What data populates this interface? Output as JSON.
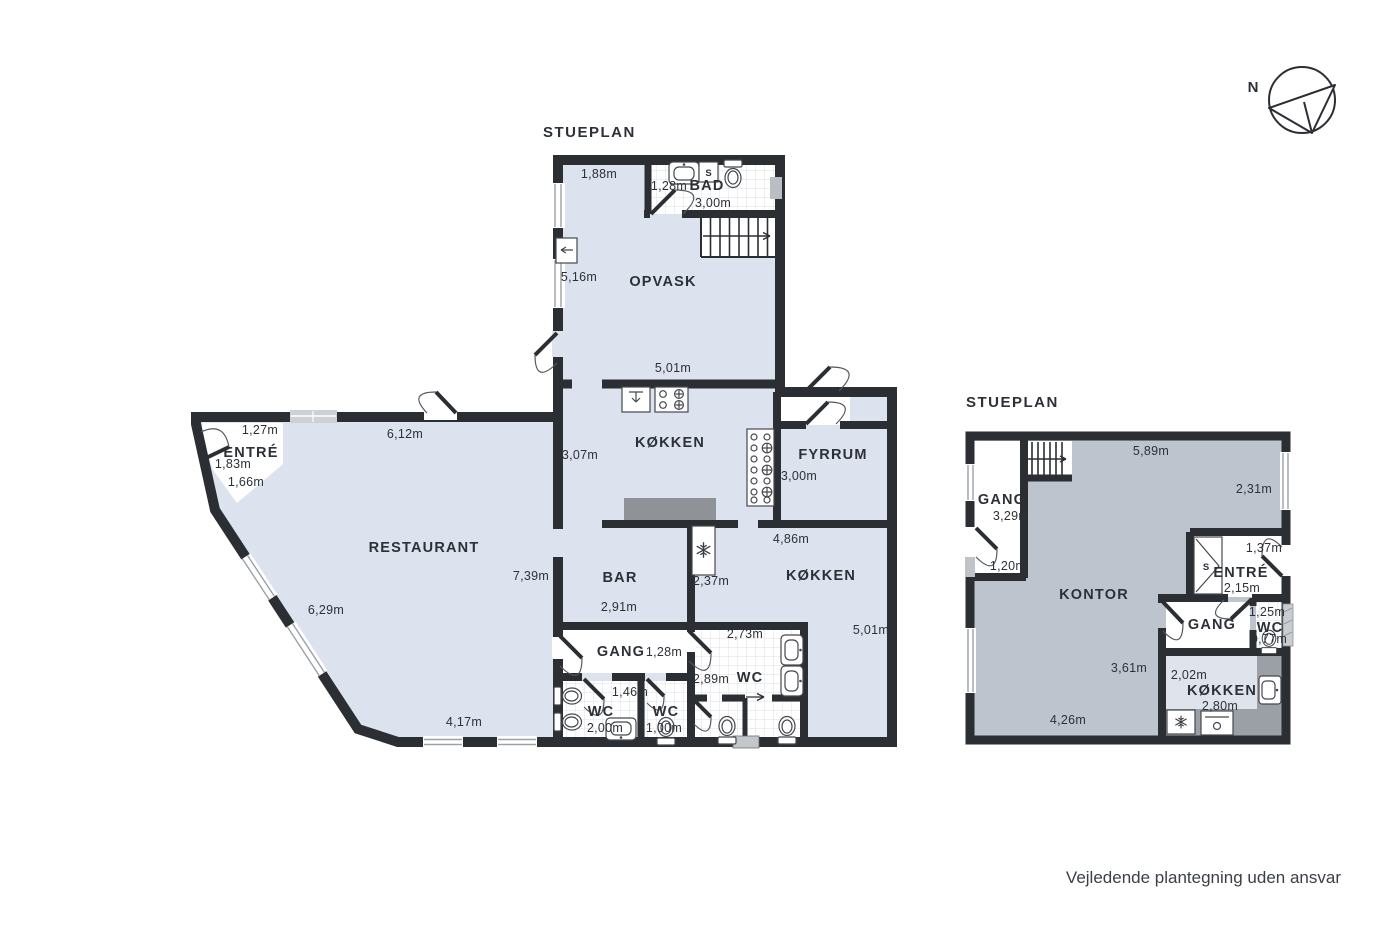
{
  "page": {
    "footer": "Vejledende plantegning uden ansvar",
    "compass_label": "N"
  },
  "colors": {
    "wall": "#2b2e33",
    "floor_light": "#dce2ee",
    "floor_gray": "#bec4cd",
    "floor_kitchen_upper": "#dfe3eb",
    "counter": "#8f9297",
    "counter_upper": "#9aa0a6",
    "tile_line": "#dcdfe3"
  },
  "plan_main": {
    "title": "STUEPLAN",
    "labels": {
      "bad": "BAD",
      "opvask": "OPVASK",
      "kokken_top": "KØKKEN",
      "fyrrum": "FYRRUM",
      "restaurant": "RESTAURANT",
      "entre": "ENTRÉ",
      "bar": "BAR",
      "kokken_right": "KØKKEN",
      "gang": "GANG",
      "wc_left": "WC",
      "wc_mid": "WC",
      "wc_right": "WC",
      "closet": "S"
    },
    "dims": {
      "top_width": "1,88m",
      "bad_door": "1,28m",
      "bad_width": "3,00m",
      "opvask_height": "5,16m",
      "kokken_top_width": "5,01m",
      "kokken_height": "3,07m",
      "fyrrum_height": "3,00m",
      "entre_top": "1,27m",
      "entre_door": "1,83m",
      "entre_inner": "1,66m",
      "rest_top": "6,12m",
      "rest_right": "7,39m",
      "rest_diag": "6,29m",
      "rest_bottom": "4,17m",
      "bar_width": "2,91m",
      "fridge": "2,37m",
      "kokken2_top": "4,86m",
      "kokken2_height": "5,01m",
      "gang_door": "1,28m",
      "wc_right_top": "2,73m",
      "wc_right_height": "2,89m",
      "wc_left_door": "1,46m",
      "wc_left_width": "2,00m",
      "wc_mid_width": "1,00m"
    }
  },
  "plan_upper": {
    "title": "STUEPLAN",
    "labels": {
      "gang_upper": "GANG",
      "kontor": "KONTOR",
      "entre": "ENTRÉ",
      "closet": "S",
      "gang_lower": "GANG",
      "wc": "WC",
      "kokken": "KØKKEN"
    },
    "dims": {
      "top": "5,89m",
      "right": "2,31m",
      "gang_height": "3,29m",
      "gang_door": "1,20m",
      "entre_door": "1,37m",
      "entre_height": "2,15m",
      "wc_width": "1,25m",
      "wc_height": "0,77m",
      "kontor_height": "3,61m",
      "kontor_width": "4,26m",
      "kokken_height": "2,02m",
      "kokken_width": "2,80m"
    }
  }
}
